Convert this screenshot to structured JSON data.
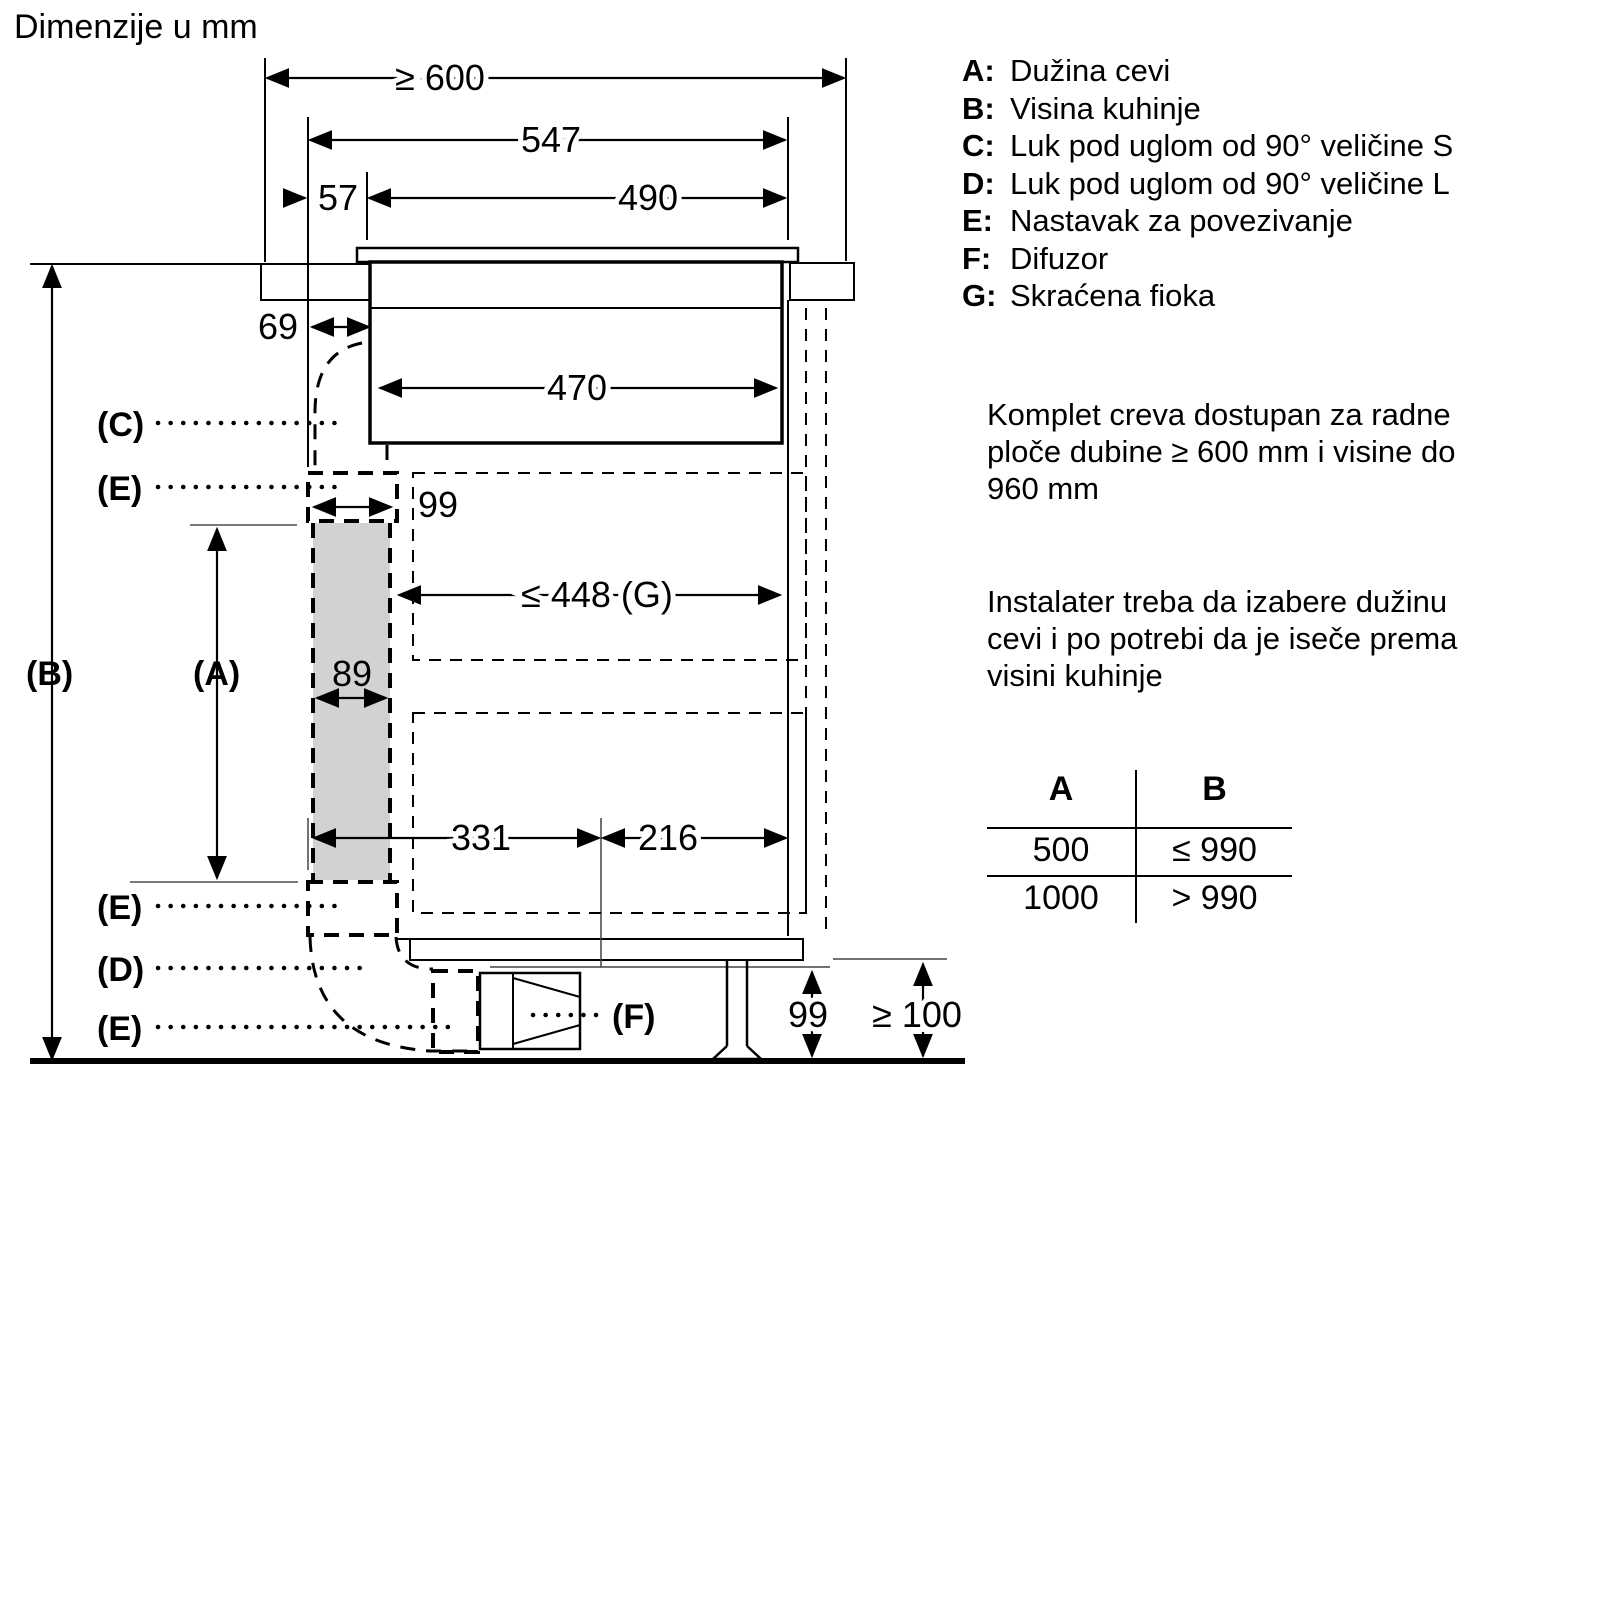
{
  "title": "Dimenzije u mm",
  "legend": [
    {
      "key": "A:",
      "text": "Dužina cevi"
    },
    {
      "key": "B:",
      "text": "Visina kuhinje"
    },
    {
      "key": "C:",
      "text": "Luk pod uglom od 90° veličine S"
    },
    {
      "key": "D:",
      "text": "Luk pod uglom od 90° veličine L"
    },
    {
      "key": "E:",
      "text": "Nastavak za povezivanje"
    },
    {
      "key": "F:",
      "text": "Difuzor"
    },
    {
      "key": "G:",
      "text": "Skraćena fioka"
    }
  ],
  "notes": {
    "hose_kit": [
      "Komplet creva dostupan za radne",
      "ploče dubine ≥ 600 mm i visine do",
      "960 mm"
    ],
    "installer": [
      "Instalater treba da izabere dužinu",
      "cevi i po potrebi da je iseče prema",
      "visini kuhinje"
    ]
  },
  "table": {
    "headers": [
      "A",
      "B"
    ],
    "rows": [
      [
        "500",
        "≤ 990"
      ],
      [
        "1000",
        "> 990"
      ]
    ]
  },
  "dims": {
    "worktop_depth": "≥ 600",
    "hob_total": "547",
    "rear_offset": "57",
    "cutout": "490",
    "duct_clearance": "69",
    "body_width": "470",
    "connector_h": "99",
    "drawer": "≤ 448 (G)",
    "duct_w": "89",
    "front_span": "331",
    "rear_span": "216",
    "plinth_h": "99",
    "floor_gap": "≥ 100"
  },
  "parts": {
    "a": "(A)",
    "b": "(B)",
    "c": "(C)",
    "d": "(D)",
    "e": "(E)",
    "f": "(F)"
  }
}
